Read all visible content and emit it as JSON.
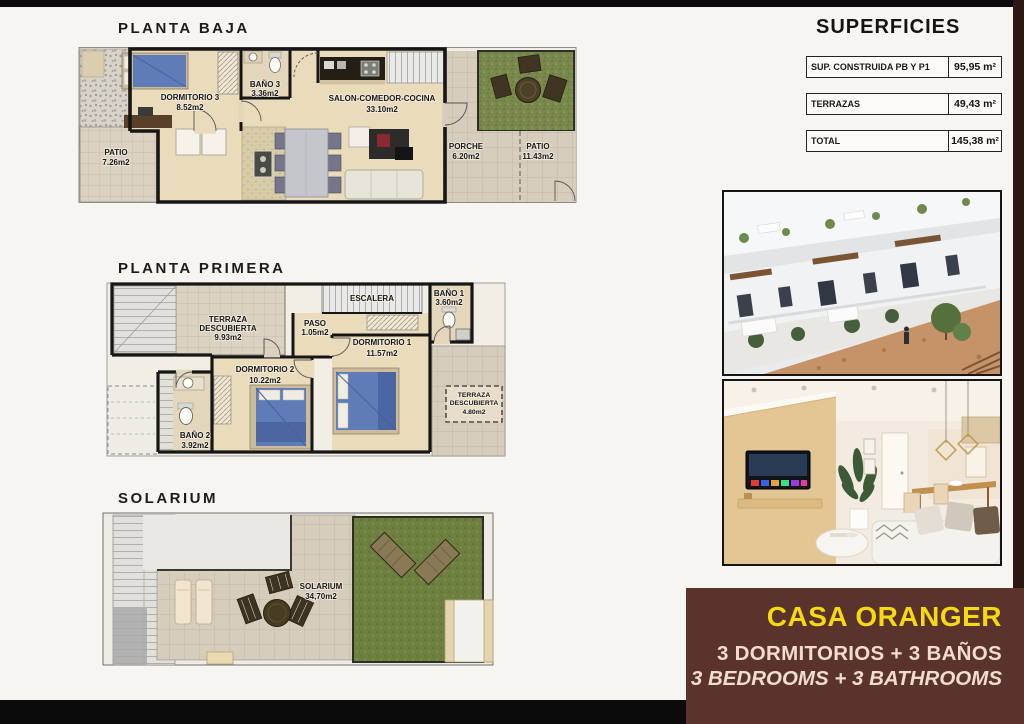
{
  "page": {
    "background": "#f7f5f2",
    "bar_color": "#0b0b0b",
    "brand_bg": "#5a332c",
    "brand_yellow": "#f6d90f",
    "brand_cream": "#f2dcca"
  },
  "plans": {
    "baja": {
      "title": "PLANTA BAJA",
      "labels": {
        "dormitorio3": [
          "DORMITORIO 3",
          "8.52m2"
        ],
        "bano3": [
          "BAÑO 3",
          "3.36m2"
        ],
        "salon": [
          "SALON-COMEDOR-COCINA",
          "33.10m2"
        ],
        "patio_izq": [
          "PATIO",
          "7.26m2"
        ],
        "porche": [
          "PORCHE",
          "6.20m2"
        ],
        "patio_der": [
          "PATIO",
          "11.43m2"
        ]
      }
    },
    "primera": {
      "title": "PLANTA PRIMERA",
      "labels": {
        "terraza": [
          "TERRAZA",
          "DESCUBIERTA",
          "9.93m2"
        ],
        "escalera": [
          "ESCALERA"
        ],
        "bano1": [
          "BAÑO 1",
          "3.60m2"
        ],
        "paso": [
          "PASO",
          "1.05m2"
        ],
        "dormitorio2": [
          "DORMITORIO 2",
          "10.22m2"
        ],
        "dormitorio1": [
          "DORMITORIO 1",
          "11.57m2"
        ],
        "bano2": [
          "BAÑO 2",
          "3.92m2"
        ],
        "terraza2": [
          "TERRAZA",
          "DESCUBIERTA",
          "4.80m2"
        ]
      }
    },
    "solarium": {
      "title": "SOLARIUM",
      "labels": {
        "solarium": [
          "SOLARIUM",
          "34,70m2"
        ]
      }
    }
  },
  "superficies": {
    "title": "SUPERFICIES",
    "rows": [
      {
        "label": "SUP. CONSTRUIDA PB Y P1",
        "value": "95,95 m²"
      },
      {
        "label": "TERRAZAS",
        "value": "49,43 m²"
      },
      {
        "label": "TOTAL",
        "value": "145,38 m²"
      }
    ]
  },
  "brand": {
    "name": "CASA ORANGER",
    "line_es": "3 DORMITORIOS + 3 BAÑOS",
    "line_en": "3 BEDROOMS + 3 BATHROOMS"
  }
}
